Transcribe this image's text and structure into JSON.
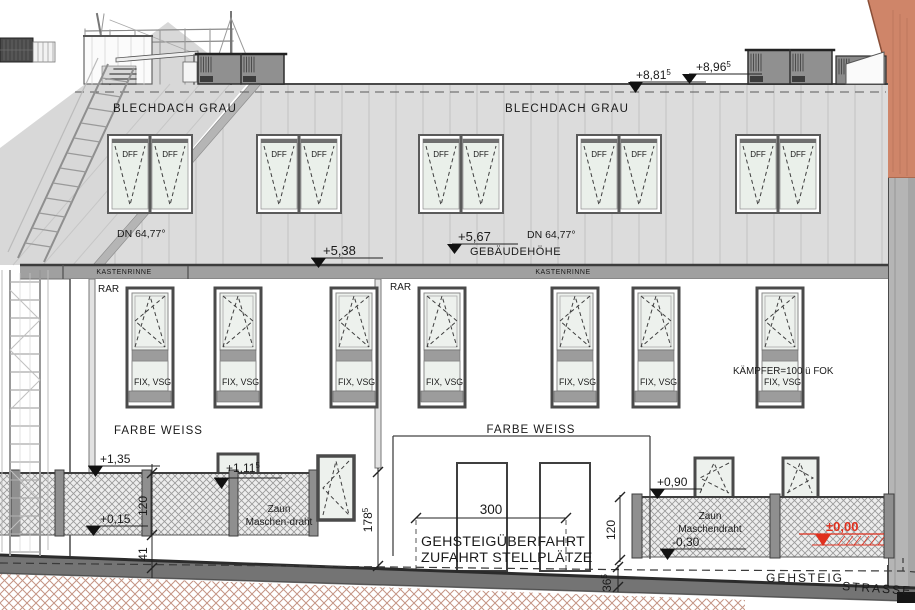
{
  "drawing": {
    "roof": {
      "material_label": "BLECHDACH GRAU",
      "skylight_label": "DFF",
      "slope_label": "DN 64,77°"
    },
    "gutter_label": "KASTENRINNE",
    "downpipe_label": "RAR",
    "levels": {
      "ridge_upper": {
        "value": "+8,96",
        "sup": "5"
      },
      "ridge_lower": {
        "value": "+8,81",
        "sup": "5"
      },
      "eaves": {
        "value": "+5,38"
      },
      "building_height": {
        "value": "+5,67"
      },
      "building_height_label": "GEBÄUDEHÖHE",
      "fence_left_top": {
        "value": "+1,35"
      },
      "sill": {
        "value": "+1,11",
        "sup": "5"
      },
      "terrain_left": {
        "value": "+0,15"
      },
      "fence_right_top": {
        "value": "+0,90"
      },
      "terrain_right": {
        "value": "-0,30"
      },
      "zero_level": {
        "value": "±0,00"
      }
    },
    "window_note_fix": "FIX, VSG",
    "window_note_kaempfer": "KÄMPFER=100 ü FOK",
    "facade_color_note": "FARBE WEISS",
    "fence_left": {
      "line1": "Zaun",
      "line2": "Maschen-draht"
    },
    "fence_right": {
      "line1": "Zaun",
      "line2": "Maschendraht"
    },
    "driveway": {
      "width": "300",
      "line1": "GEHSTEIGÜBERFAHRT",
      "line2": "ZUFAHRT STELLPLÄTZE"
    },
    "dimensions": {
      "fence_left_height": "120",
      "plinth_left": "41",
      "parapet": {
        "value": "178",
        "sup": "5"
      },
      "fence_right_height": "120",
      "curb": {
        "value": "36",
        "sup": "5"
      }
    },
    "ground": {
      "sidewalk": "GEHSTEIG",
      "street": "STRASSE"
    },
    "colors": {
      "accent_zero": "#e0301e",
      "neighbor_building": "#cf8569",
      "roof": "#dcdcdc"
    }
  }
}
